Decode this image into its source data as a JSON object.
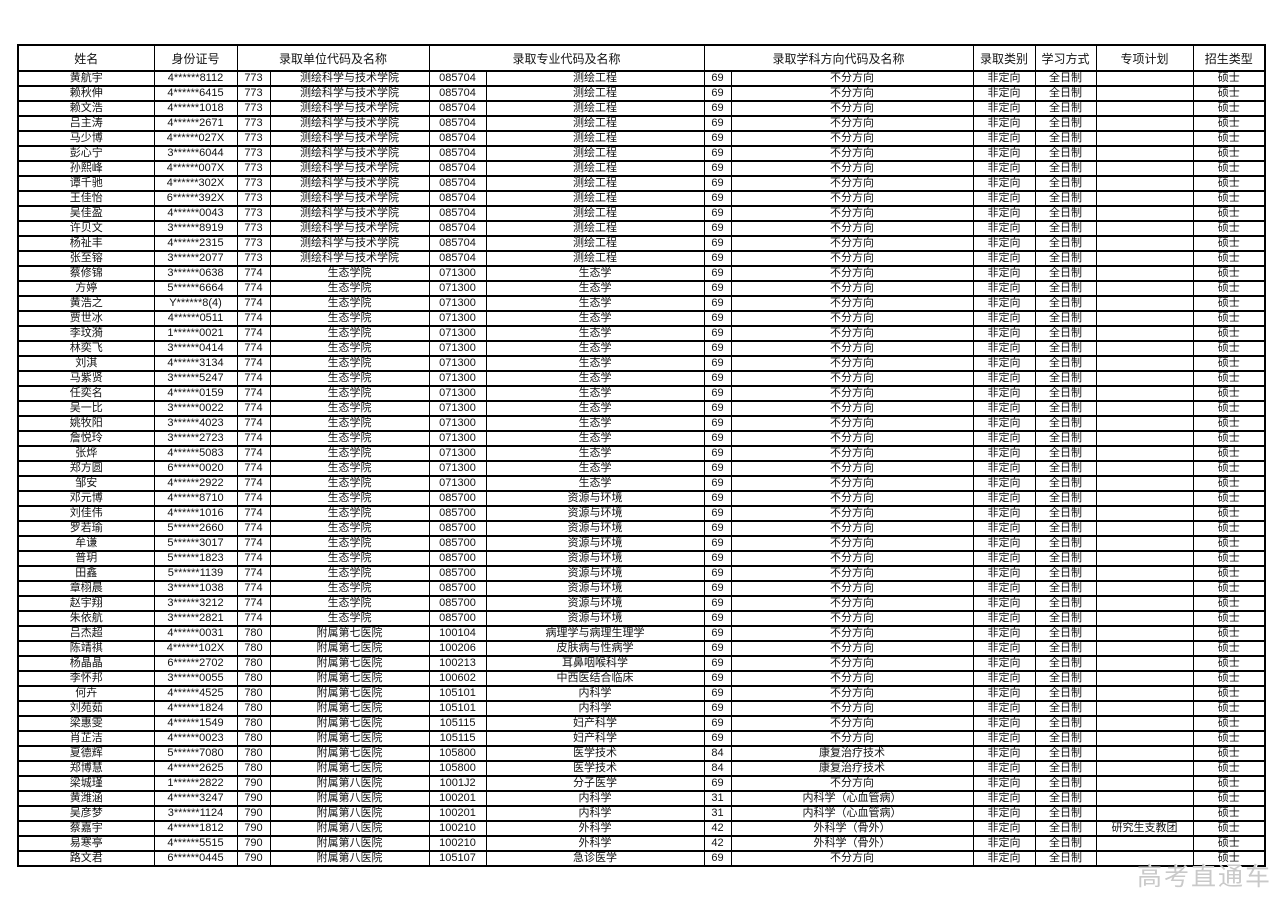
{
  "page": {
    "watermark": "高考直通车"
  },
  "table": {
    "headers": [
      "姓名",
      "身份证号",
      "录取单位代码及名称",
      "录取专业代码及名称",
      "录取学科方向代码及名称",
      "录取类别",
      "学习方式",
      "专项计划",
      "招生类型"
    ],
    "rows": [
      [
        "黄航宇",
        "4******8112",
        "773",
        "测绘科学与技术学院",
        "085704",
        "测绘工程",
        "69",
        "不分方向",
        "非定向",
        "全日制",
        "",
        "硕士"
      ],
      [
        "赖秋伸",
        "4******6415",
        "773",
        "测绘科学与技术学院",
        "085704",
        "测绘工程",
        "69",
        "不分方向",
        "非定向",
        "全日制",
        "",
        "硕士"
      ],
      [
        "赖文浩",
        "4******1018",
        "773",
        "测绘科学与技术学院",
        "085704",
        "测绘工程",
        "69",
        "不分方向",
        "非定向",
        "全日制",
        "",
        "硕士"
      ],
      [
        "吕主涛",
        "4******2671",
        "773",
        "测绘科学与技术学院",
        "085704",
        "测绘工程",
        "69",
        "不分方向",
        "非定向",
        "全日制",
        "",
        "硕士"
      ],
      [
        "马少博",
        "4******027X",
        "773",
        "测绘科学与技术学院",
        "085704",
        "测绘工程",
        "69",
        "不分方向",
        "非定向",
        "全日制",
        "",
        "硕士"
      ],
      [
        "彭心宁",
        "3******6044",
        "773",
        "测绘科学与技术学院",
        "085704",
        "测绘工程",
        "69",
        "不分方向",
        "非定向",
        "全日制",
        "",
        "硕士"
      ],
      [
        "孙熙峰",
        "4******007X",
        "773",
        "测绘科学与技术学院",
        "085704",
        "测绘工程",
        "69",
        "不分方向",
        "非定向",
        "全日制",
        "",
        "硕士"
      ],
      [
        "谭千驰",
        "4******302X",
        "773",
        "测绘科学与技术学院",
        "085704",
        "测绘工程",
        "69",
        "不分方向",
        "非定向",
        "全日制",
        "",
        "硕士"
      ],
      [
        "王佳怡",
        "6******392X",
        "773",
        "测绘科学与技术学院",
        "085704",
        "测绘工程",
        "69",
        "不分方向",
        "非定向",
        "全日制",
        "",
        "硕士"
      ],
      [
        "吴佳盈",
        "4******0043",
        "773",
        "测绘科学与技术学院",
        "085704",
        "测绘工程",
        "69",
        "不分方向",
        "非定向",
        "全日制",
        "",
        "硕士"
      ],
      [
        "许贝文",
        "3******8919",
        "773",
        "测绘科学与技术学院",
        "085704",
        "测绘工程",
        "69",
        "不分方向",
        "非定向",
        "全日制",
        "",
        "硕士"
      ],
      [
        "杨祉丰",
        "4******2315",
        "773",
        "测绘科学与技术学院",
        "085704",
        "测绘工程",
        "69",
        "不分方向",
        "非定向",
        "全日制",
        "",
        "硕士"
      ],
      [
        "张至镕",
        "3******2077",
        "773",
        "测绘科学与技术学院",
        "085704",
        "测绘工程",
        "69",
        "不分方向",
        "非定向",
        "全日制",
        "",
        "硕士"
      ],
      [
        "蔡修锦",
        "3******0638",
        "774",
        "生态学院",
        "071300",
        "生态学",
        "69",
        "不分方向",
        "非定向",
        "全日制",
        "",
        "硕士"
      ],
      [
        "方婷",
        "5******6664",
        "774",
        "生态学院",
        "071300",
        "生态学",
        "69",
        "不分方向",
        "非定向",
        "全日制",
        "",
        "硕士"
      ],
      [
        "黄浩之",
        "Y******8(4)",
        "774",
        "生态学院",
        "071300",
        "生态学",
        "69",
        "不分方向",
        "非定向",
        "全日制",
        "",
        "硕士"
      ],
      [
        "贾世冰",
        "4******0511",
        "774",
        "生态学院",
        "071300",
        "生态学",
        "69",
        "不分方向",
        "非定向",
        "全日制",
        "",
        "硕士"
      ],
      [
        "李玟漪",
        "1******0021",
        "774",
        "生态学院",
        "071300",
        "生态学",
        "69",
        "不分方向",
        "非定向",
        "全日制",
        "",
        "硕士"
      ],
      [
        "林奕飞",
        "3******0414",
        "774",
        "生态学院",
        "071300",
        "生态学",
        "69",
        "不分方向",
        "非定向",
        "全日制",
        "",
        "硕士"
      ],
      [
        "刘淇",
        "4******3134",
        "774",
        "生态学院",
        "071300",
        "生态学",
        "69",
        "不分方向",
        "非定向",
        "全日制",
        "",
        "硕士"
      ],
      [
        "马紫贤",
        "3******5247",
        "774",
        "生态学院",
        "071300",
        "生态学",
        "69",
        "不分方向",
        "非定向",
        "全日制",
        "",
        "硕士"
      ],
      [
        "任奕名",
        "4******0159",
        "774",
        "生态学院",
        "071300",
        "生态学",
        "69",
        "不分方向",
        "非定向",
        "全日制",
        "",
        "硕士"
      ],
      [
        "吴一比",
        "3******0022",
        "774",
        "生态学院",
        "071300",
        "生态学",
        "69",
        "不分方向",
        "非定向",
        "全日制",
        "",
        "硕士"
      ],
      [
        "姚牧阳",
        "3******4023",
        "774",
        "生态学院",
        "071300",
        "生态学",
        "69",
        "不分方向",
        "非定向",
        "全日制",
        "",
        "硕士"
      ],
      [
        "詹悦玲",
        "3******2723",
        "774",
        "生态学院",
        "071300",
        "生态学",
        "69",
        "不分方向",
        "非定向",
        "全日制",
        "",
        "硕士"
      ],
      [
        "张烨",
        "4******5083",
        "774",
        "生态学院",
        "071300",
        "生态学",
        "69",
        "不分方向",
        "非定向",
        "全日制",
        "",
        "硕士"
      ],
      [
        "郑方圆",
        "6******0020",
        "774",
        "生态学院",
        "071300",
        "生态学",
        "69",
        "不分方向",
        "非定向",
        "全日制",
        "",
        "硕士"
      ],
      [
        "邹安",
        "4******2922",
        "774",
        "生态学院",
        "071300",
        "生态学",
        "69",
        "不分方向",
        "非定向",
        "全日制",
        "",
        "硕士"
      ],
      [
        "邓元博",
        "4******8710",
        "774",
        "生态学院",
        "085700",
        "资源与环境",
        "69",
        "不分方向",
        "非定向",
        "全日制",
        "",
        "硕士"
      ],
      [
        "刘佳伟",
        "4******1016",
        "774",
        "生态学院",
        "085700",
        "资源与环境",
        "69",
        "不分方向",
        "非定向",
        "全日制",
        "",
        "硕士"
      ],
      [
        "罗若瑜",
        "5******2660",
        "774",
        "生态学院",
        "085700",
        "资源与环境",
        "69",
        "不分方向",
        "非定向",
        "全日制",
        "",
        "硕士"
      ],
      [
        "牟谦",
        "5******3017",
        "774",
        "生态学院",
        "085700",
        "资源与环境",
        "69",
        "不分方向",
        "非定向",
        "全日制",
        "",
        "硕士"
      ],
      [
        "普玥",
        "5******1823",
        "774",
        "生态学院",
        "085700",
        "资源与环境",
        "69",
        "不分方向",
        "非定向",
        "全日制",
        "",
        "硕士"
      ],
      [
        "田鑫",
        "5******1139",
        "774",
        "生态学院",
        "085700",
        "资源与环境",
        "69",
        "不分方向",
        "非定向",
        "全日制",
        "",
        "硕士"
      ],
      [
        "章栩晨",
        "3******1038",
        "774",
        "生态学院",
        "085700",
        "资源与环境",
        "69",
        "不分方向",
        "非定向",
        "全日制",
        "",
        "硕士"
      ],
      [
        "赵宇翔",
        "3******3212",
        "774",
        "生态学院",
        "085700",
        "资源与环境",
        "69",
        "不分方向",
        "非定向",
        "全日制",
        "",
        "硕士"
      ],
      [
        "朱依航",
        "3******2821",
        "774",
        "生态学院",
        "085700",
        "资源与环境",
        "69",
        "不分方向",
        "非定向",
        "全日制",
        "",
        "硕士"
      ],
      [
        "吕杰超",
        "4******0031",
        "780",
        "附属第七医院",
        "100104",
        "病理学与病理生理学",
        "69",
        "不分方向",
        "非定向",
        "全日制",
        "",
        "硕士"
      ],
      [
        "陈靖祺",
        "4******102X",
        "780",
        "附属第七医院",
        "100206",
        "皮肤病与性病学",
        "69",
        "不分方向",
        "非定向",
        "全日制",
        "",
        "硕士"
      ],
      [
        "杨晶晶",
        "6******2702",
        "780",
        "附属第七医院",
        "100213",
        "耳鼻咽喉科学",
        "69",
        "不分方向",
        "非定向",
        "全日制",
        "",
        "硕士"
      ],
      [
        "李怀邦",
        "3******0055",
        "780",
        "附属第七医院",
        "100602",
        "中西医结合临床",
        "69",
        "不分方向",
        "非定向",
        "全日制",
        "",
        "硕士"
      ],
      [
        "何卉",
        "4******4525",
        "780",
        "附属第七医院",
        "105101",
        "内科学",
        "69",
        "不分方向",
        "非定向",
        "全日制",
        "",
        "硕士"
      ],
      [
        "刘苑茹",
        "4******1824",
        "780",
        "附属第七医院",
        "105101",
        "内科学",
        "69",
        "不分方向",
        "非定向",
        "全日制",
        "",
        "硕士"
      ],
      [
        "梁惠雯",
        "4******1549",
        "780",
        "附属第七医院",
        "105115",
        "妇产科学",
        "69",
        "不分方向",
        "非定向",
        "全日制",
        "",
        "硕士"
      ],
      [
        "肖芷洁",
        "4******0023",
        "780",
        "附属第七医院",
        "105115",
        "妇产科学",
        "69",
        "不分方向",
        "非定向",
        "全日制",
        "",
        "硕士"
      ],
      [
        "夏德辉",
        "5******7080",
        "780",
        "附属第七医院",
        "105800",
        "医学技术",
        "84",
        "康复治疗技术",
        "非定向",
        "全日制",
        "",
        "硕士"
      ],
      [
        "郑博慧",
        "4******2625",
        "780",
        "附属第七医院",
        "105800",
        "医学技术",
        "84",
        "康复治疗技术",
        "非定向",
        "全日制",
        "",
        "硕士"
      ],
      [
        "梁城瑾",
        "1******2822",
        "790",
        "附属第八医院",
        "1001J2",
        "分子医学",
        "69",
        "不分方向",
        "非定向",
        "全日制",
        "",
        "硕士"
      ],
      [
        "黄潍涵",
        "4******3247",
        "790",
        "附属第八医院",
        "100201",
        "内科学",
        "31",
        "内科学（心血管病）",
        "非定向",
        "全日制",
        "",
        "硕士"
      ],
      [
        "吴彦梦",
        "3******1124",
        "790",
        "附属第八医院",
        "100201",
        "内科学",
        "31",
        "内科学（心血管病）",
        "非定向",
        "全日制",
        "",
        "硕士"
      ],
      [
        "蔡嘉宇",
        "4******1812",
        "790",
        "附属第八医院",
        "100210",
        "外科学",
        "42",
        "外科学（骨外）",
        "非定向",
        "全日制",
        "研究生支教团",
        "硕士"
      ],
      [
        "易寒亭",
        "4******5515",
        "790",
        "附属第八医院",
        "100210",
        "外科学",
        "42",
        "外科学（骨外）",
        "非定向",
        "全日制",
        "",
        "硕士"
      ],
      [
        "路文君",
        "6******0445",
        "790",
        "附属第八医院",
        "105107",
        "急诊医学",
        "69",
        "不分方向",
        "非定向",
        "全日制",
        "",
        "硕士"
      ]
    ]
  }
}
